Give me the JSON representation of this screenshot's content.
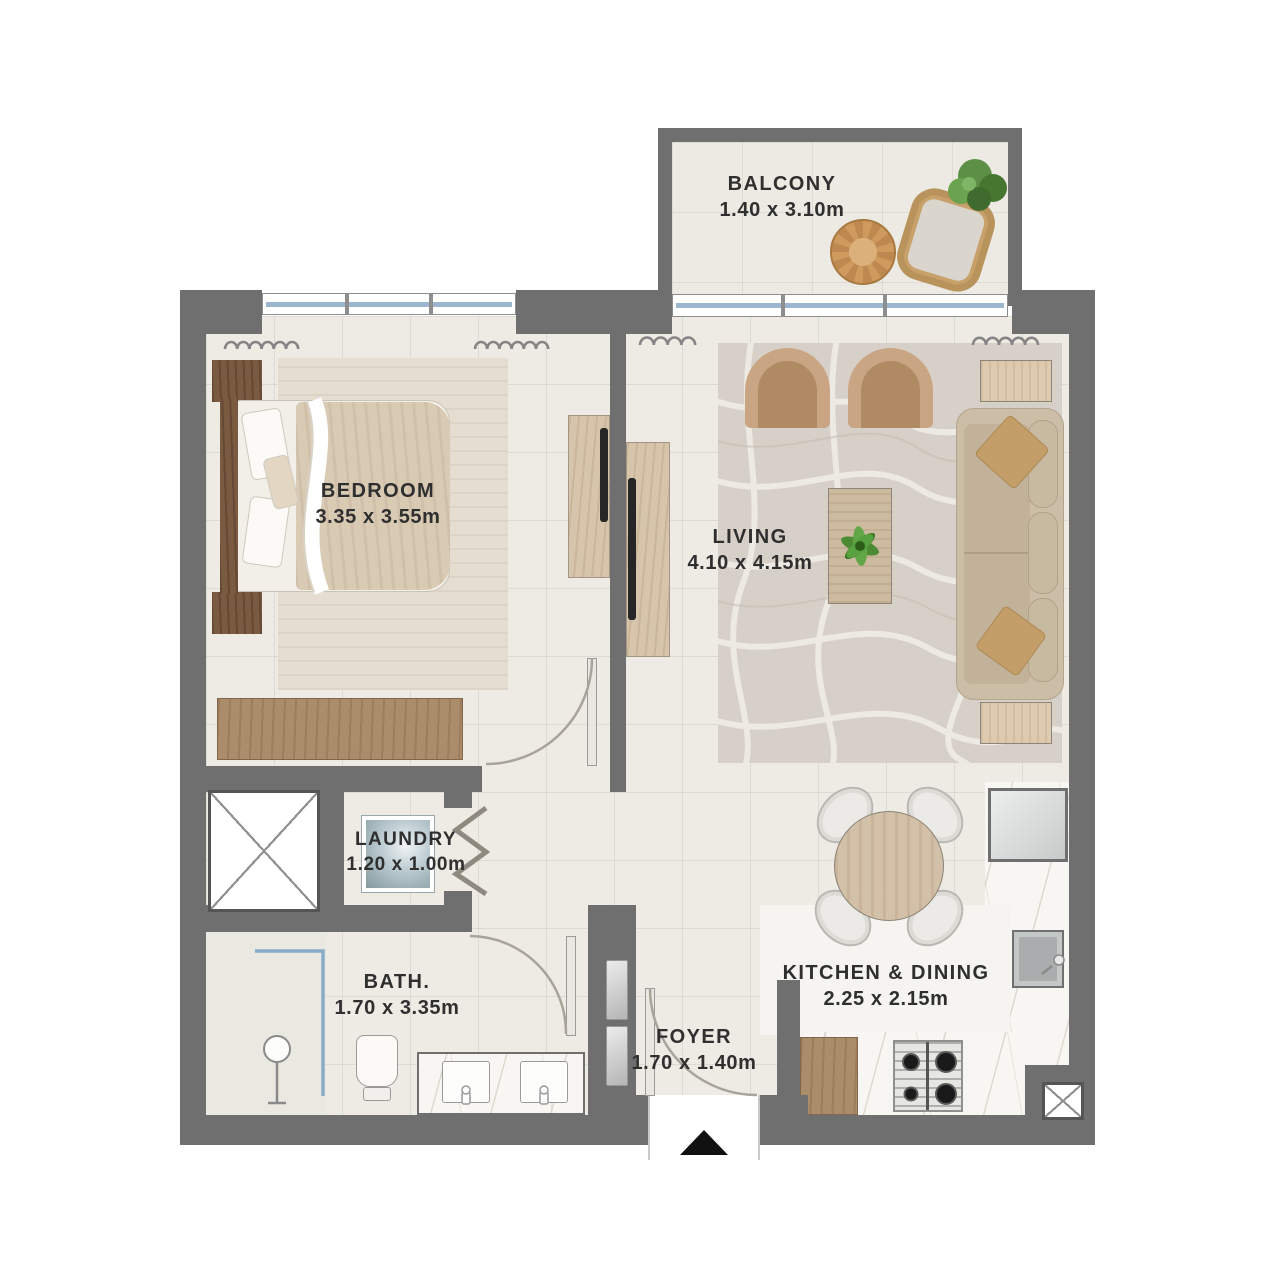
{
  "title": "Apartment Floor Plan",
  "rooms": {
    "balcony": {
      "name": "BALCONY",
      "dims": "1.40 x 3.10m"
    },
    "bedroom": {
      "name": "BEDROOM",
      "dims": "3.35 x 3.55m"
    },
    "living": {
      "name": "LIVING",
      "dims": "4.10 x 4.15m"
    },
    "laundry": {
      "name": "LAUNDRY",
      "dims": "1.20 x 1.00m"
    },
    "bath": {
      "name": "BATH.",
      "dims": "1.70 x 3.35m"
    },
    "foyer": {
      "name": "FOYER",
      "dims": "1.70 x 1.40m"
    },
    "kitchen": {
      "name": "KITCHEN & DINING",
      "dims": "2.25 x 2.15m"
    }
  },
  "colors": {
    "wall": "#6f6f6f",
    "floor_tile": "#edebe4",
    "living_rug": "#d7d0c8",
    "glass_blue": "#9cb6d0",
    "wood_dark": "#7b5a42",
    "wood_light": "#ab8d6b",
    "plant_green": "#4c8a33",
    "entry_arrow": "#111111"
  }
}
